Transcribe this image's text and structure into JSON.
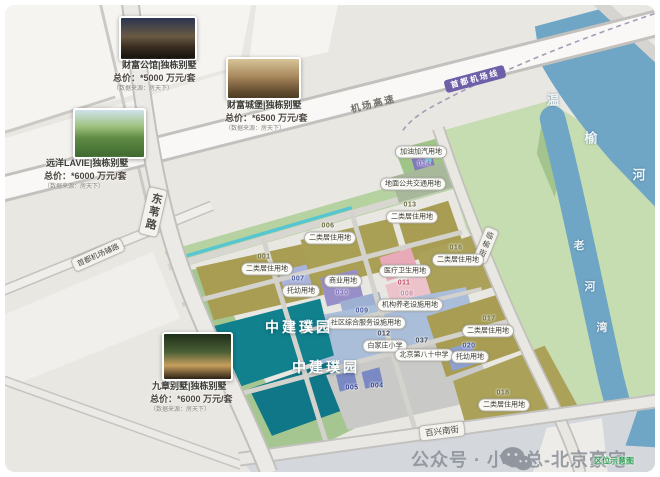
{
  "corner_note": "区位示意图",
  "watermark": {
    "text": "公众号 · 小包总-北京豪宅",
    "icon": "wechat-icon"
  },
  "development_labels": [
    "中建璞园",
    "中建璞园"
  ],
  "cards": [
    {
      "title": "财富公馆|独栋别墅",
      "price": "总价：*5000 万元/套",
      "note": "（数据来源：房天下）"
    },
    {
      "title": "财富城堡|独栋别墅",
      "price": "总价：*6500 万元/套",
      "note": "（数据来源：房天下）"
    },
    {
      "title": "远洋LAVIE|独栋别墅",
      "price": "总价：*6000 万元/套",
      "note": "（数据来源：房天下）"
    },
    {
      "title": "九章别墅|独栋别墅",
      "price": "总价：*6000 万元/套",
      "note": "（数据来源：房天下）"
    }
  ],
  "roads": {
    "dongwei_road": "东苇路",
    "airport_expressway": "机场高速",
    "capital_airport_express_line": "首都机场线",
    "airport_side_road": "首都机场辅路",
    "linyu_street": "临榆街",
    "baixing_south_street": "百兴南街"
  },
  "rivers": {
    "wenyu": [
      "温",
      "榆",
      "河"
    ],
    "laohewan": [
      "老",
      "河",
      "湾"
    ]
  },
  "parcels": [
    {
      "num": "014",
      "label": "加油加汽用地"
    },
    {
      "num": "",
      "label": "地面公共交通用地"
    },
    {
      "num": "001",
      "label": "二类居住用地"
    },
    {
      "num": "006",
      "label": "二类居住用地"
    },
    {
      "num": "013",
      "label": "二类居住用地"
    },
    {
      "num": "016",
      "label": "二类居住用地"
    },
    {
      "num": "007",
      "label": "托幼用地"
    },
    {
      "num": "030",
      "label": "商业用地"
    },
    {
      "num": "011",
      "label": "医疗卫生用地"
    },
    {
      "num": "008",
      "label": "机构养老设施用地"
    },
    {
      "num": "009",
      "label": "社区综合服务设施用地"
    },
    {
      "num": "012",
      "label": "白家庄小学"
    },
    {
      "num": "037",
      "label": "北京第八十中学"
    },
    {
      "num": "017",
      "label": "二类居住用地"
    },
    {
      "num": "020",
      "label": "托幼用地"
    },
    {
      "num": "018",
      "label": "二类居住用地"
    },
    {
      "num": "005",
      "label": ""
    },
    {
      "num": "004",
      "label": ""
    }
  ],
  "palette": {
    "residential_olive": "#a89d52",
    "greenbelt": "#b6d2a1",
    "river_blue": "#6fa5c5",
    "east_green": "#c6dcb1",
    "development_teal": "#11818e",
    "school_blue": "#aabeda",
    "purple_parcel": "#988fc8",
    "pink_parcel": "#e8aab8",
    "subway_badge": "#6f5fa8",
    "watermark_gray": "#8b8f99",
    "corner_green": "#2f9e53"
  }
}
